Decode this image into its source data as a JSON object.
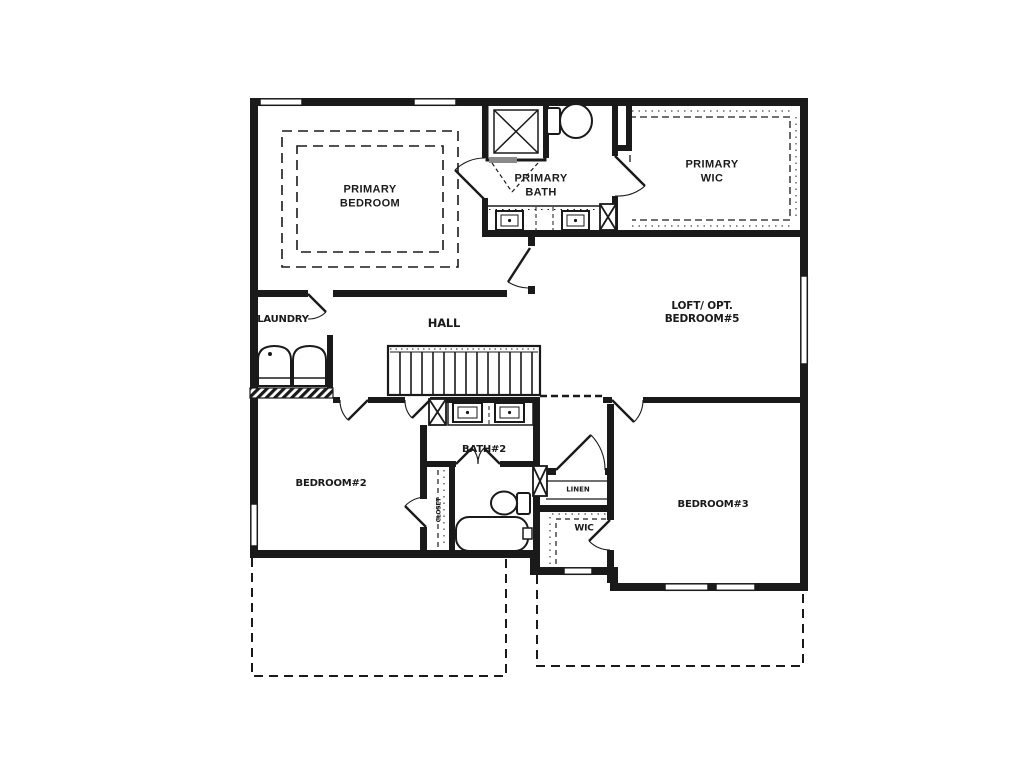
{
  "plan": {
    "type": "floor-plan",
    "colors": {
      "wall": "#1a1a1a",
      "background": "#ffffff",
      "threshold_gray": "#8a8a8a"
    },
    "rooms": {
      "primary_bedroom": "PRIMARY\nBEDROOM",
      "primary_bath": "PRIMARY\nBATH",
      "primary_wic": "PRIMARY\nWIC",
      "laundry": "LAUNDRY",
      "hall": "HALL",
      "loft": "LOFT/ OPT.\nBEDROOM#5",
      "bedroom2": "BEDROOM#2",
      "closet": "CLOSET",
      "bath2": "BATH#2",
      "linen": "LINEN",
      "wic": "WIC",
      "bedroom3": "BEDROOM#3"
    },
    "fixtures": [
      "shower-icon",
      "toilet-icon",
      "double-vanity-sinks-icon",
      "bathtub-icon",
      "washer-dryer-icon",
      "stairs-icon",
      "tray-ceiling-dashed-outline",
      "closet-shelf-dashes",
      "window-symbols",
      "door-swing-arcs",
      "lower-level-dashed-outline"
    ]
  }
}
